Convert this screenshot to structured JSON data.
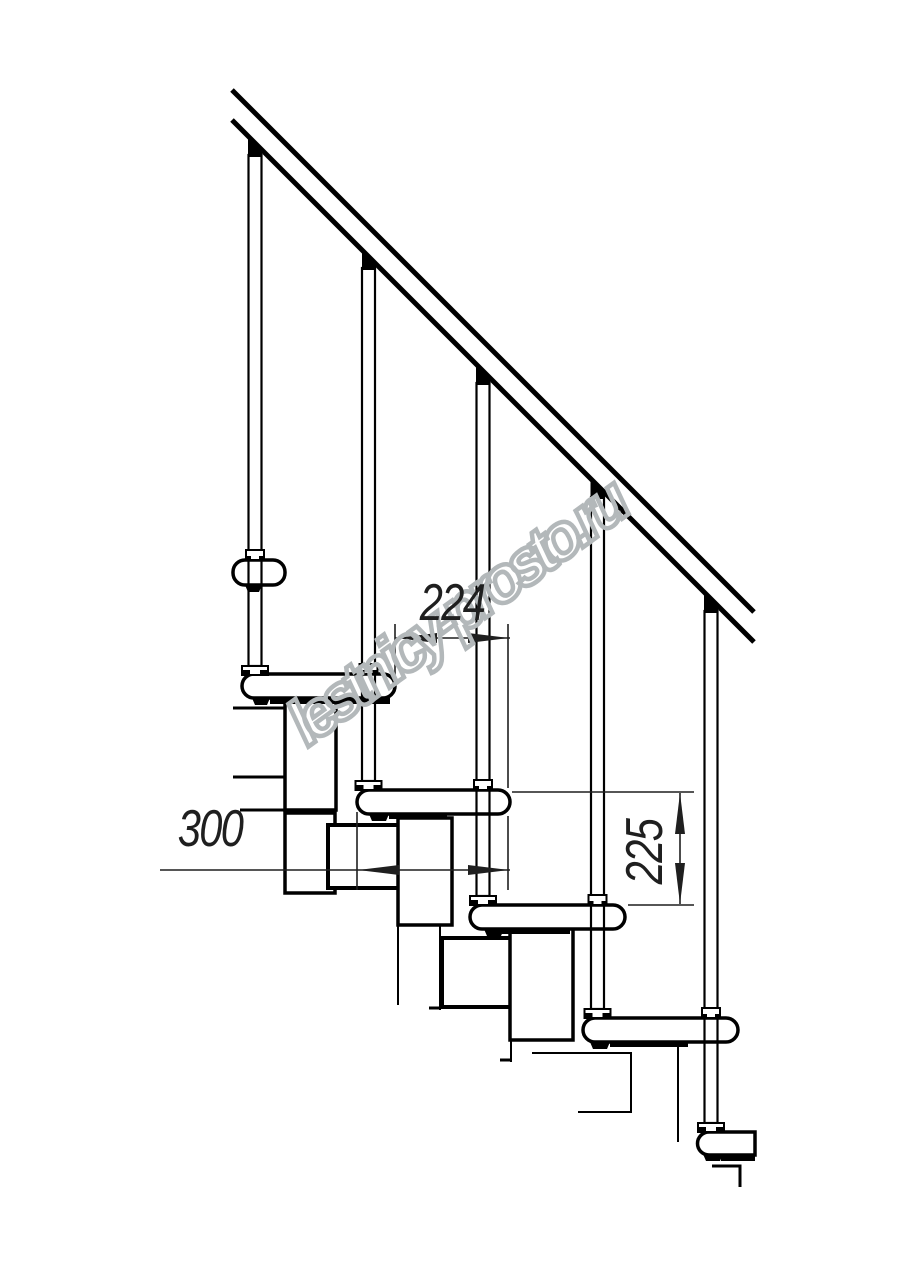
{
  "drawing": {
    "watermark_text": "lestnicy-prosto.ru",
    "dimensions": {
      "step_run": "224",
      "tread_depth": "300",
      "riser_height": "225"
    }
  },
  "colors": {
    "bg": "#ffffff",
    "line": "#000000",
    "dim": "#1f1f1f",
    "wm": "#b3b8ba"
  }
}
